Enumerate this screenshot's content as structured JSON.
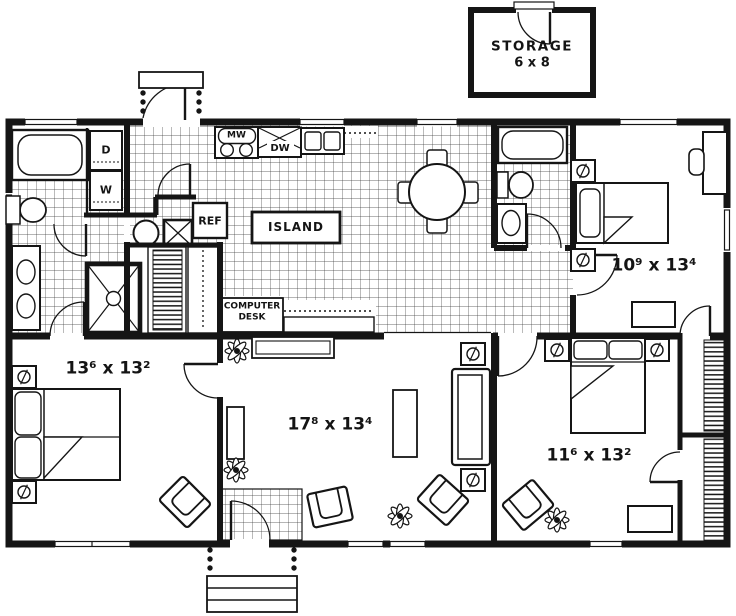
{
  "colors": {
    "wall": "#151515",
    "background": "#ffffff",
    "tile_line": "#3a3a3a"
  },
  "labels": {
    "storage_name": "STORAGE",
    "storage_size": "6 x 8",
    "dryer": "D",
    "washer": "W",
    "microwave": "MW",
    "dishwasher": "DW",
    "refrigerator": "REF",
    "island": "ISLAND",
    "computer_desk_line1": "COMPUTER",
    "computer_desk_line2": "DESK",
    "bedroom_left_dims": "13⁶ x 13²",
    "living_dims": "17⁸ x 13⁴",
    "bedroom_right_dims": "11⁶ x 13²",
    "bedroom_top_right_dims": "10⁹ x 13⁴"
  }
}
